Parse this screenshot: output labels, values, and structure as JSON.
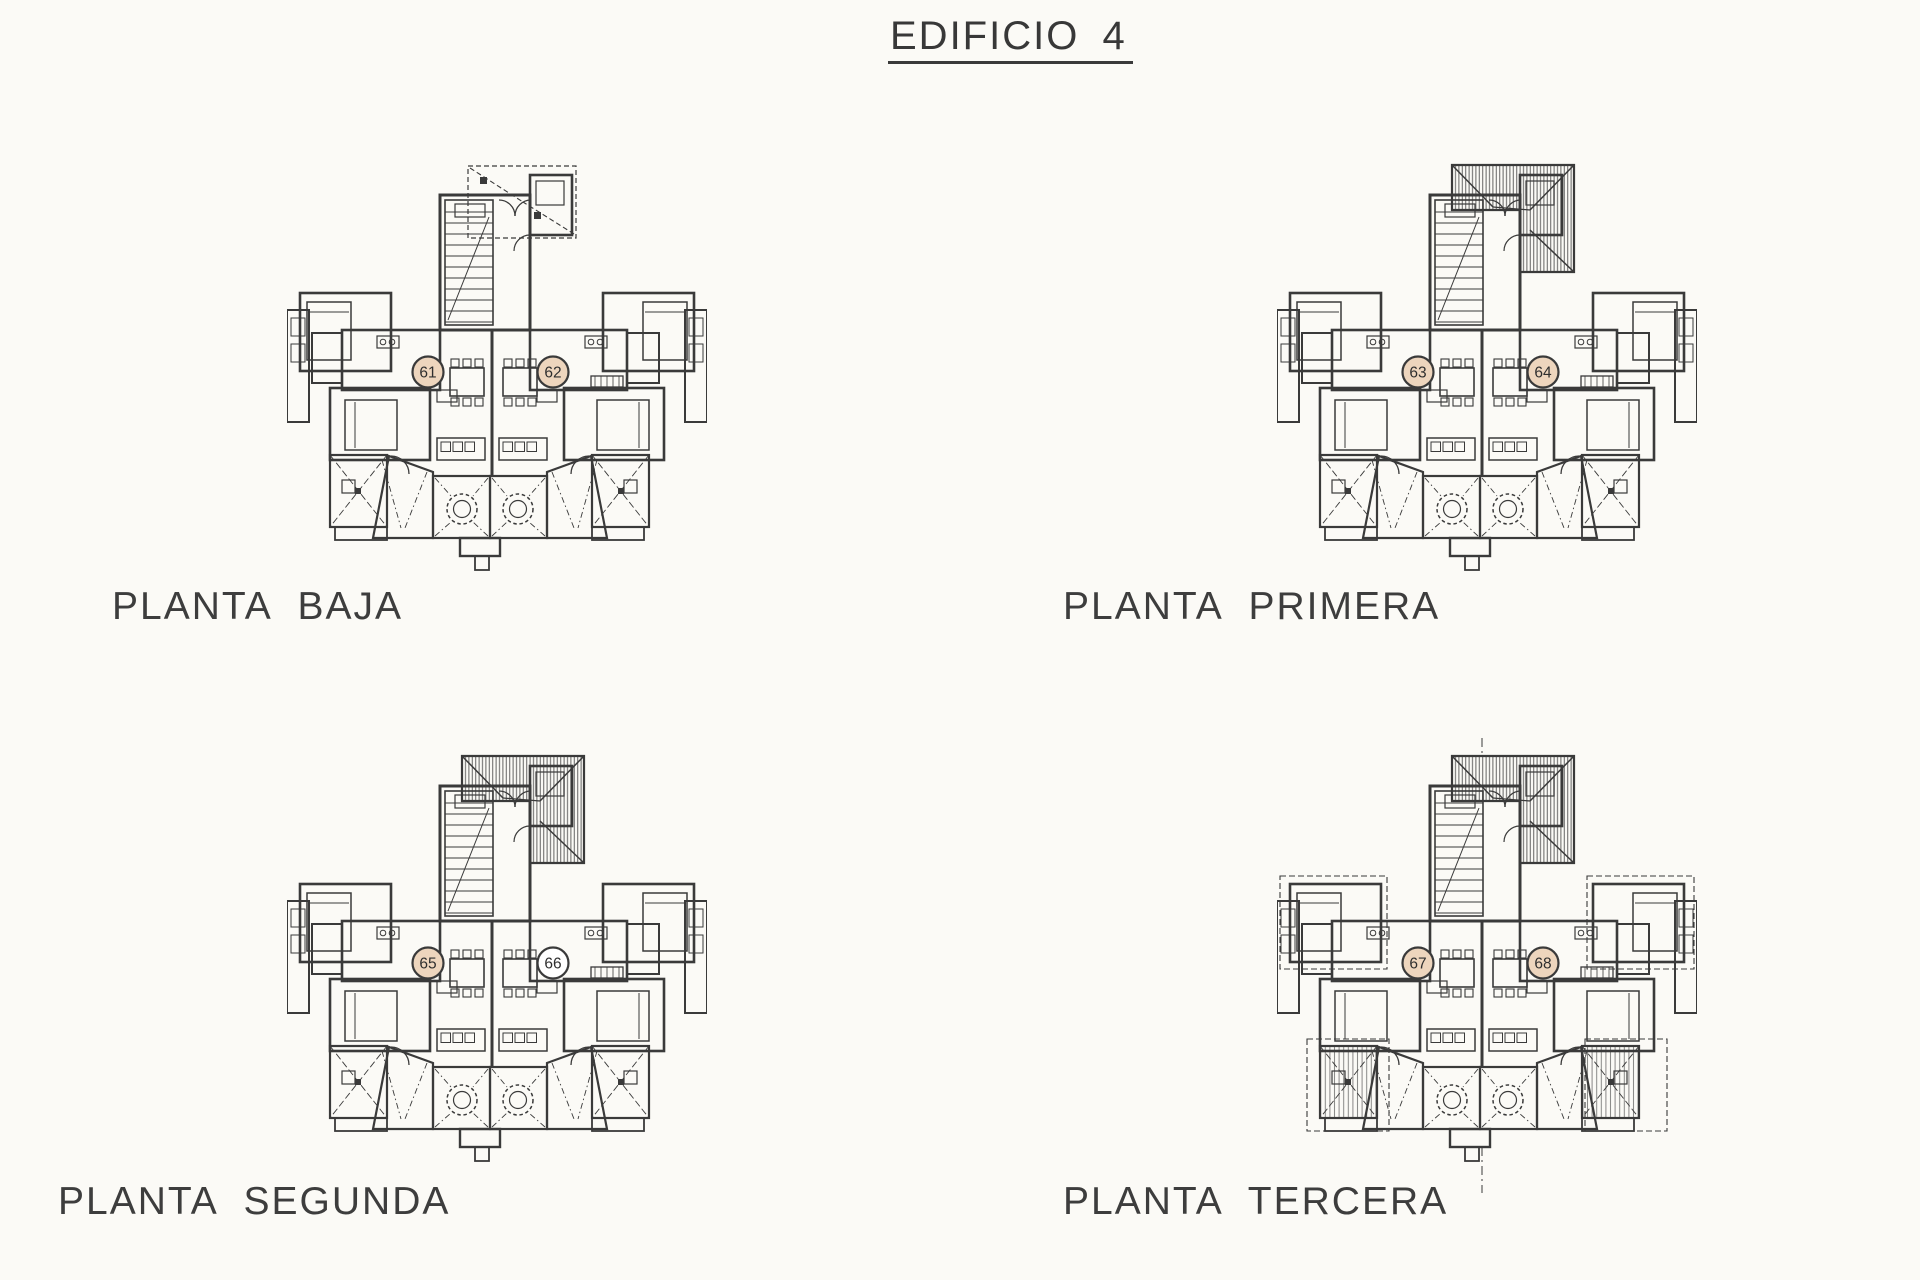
{
  "document": {
    "title": "EDIFICIO 4"
  },
  "colors": {
    "line": "#3a3a3a",
    "paper": "#fbfaf6",
    "unit_badge_fill": "#edd5bd",
    "unit_badge_empty": "#ffffff",
    "text": "#3c3c3c"
  },
  "plans": [
    {
      "id": "planta-baja",
      "label": "PLANTA BAJA",
      "roof_style": "dashed-outline",
      "units": [
        {
          "number": "61",
          "highlighted": true
        },
        {
          "number": "62",
          "highlighted": true
        }
      ]
    },
    {
      "id": "planta-primera",
      "label": "PLANTA PRIMERA",
      "roof_style": "hatched",
      "units": [
        {
          "number": "63",
          "highlighted": true
        },
        {
          "number": "64",
          "highlighted": true
        }
      ]
    },
    {
      "id": "planta-segunda",
      "label": "PLANTA SEGUNDA",
      "roof_style": "hatched",
      "units": [
        {
          "number": "65",
          "highlighted": true
        },
        {
          "number": "66",
          "highlighted": false
        }
      ]
    },
    {
      "id": "planta-tercera",
      "label": "PLANTA TERCERA",
      "roof_style": "hatched-with-overhang",
      "units": [
        {
          "number": "67",
          "highlighted": true
        },
        {
          "number": "68",
          "highlighted": true
        }
      ]
    }
  ]
}
